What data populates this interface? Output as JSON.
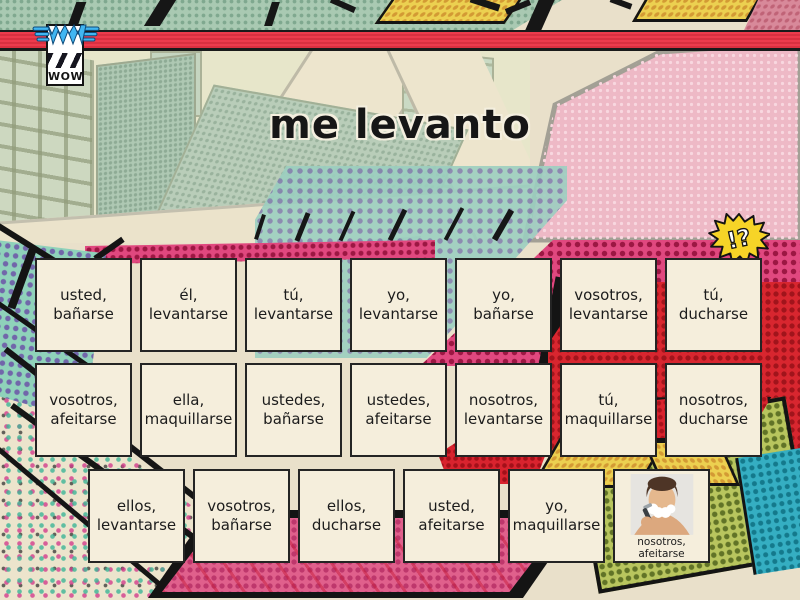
{
  "logo": {
    "text": "WOW"
  },
  "title": "me levanto",
  "burst": {
    "text": "!?"
  },
  "board": {
    "rows": [
      {
        "tiles": [
          {
            "label": "usted,\nbañarse"
          },
          {
            "label": "él,\nlevantarse"
          },
          {
            "label": "tú,\nlevantarse"
          },
          {
            "label": "yo,\nlevantarse"
          },
          {
            "label": "yo,\nbañarse"
          },
          {
            "label": "vosotros,\nlevantarse"
          },
          {
            "label": "tú,\nducharse"
          }
        ]
      },
      {
        "tiles": [
          {
            "label": "vosotros,\nafeitarse"
          },
          {
            "label": "ella,\nmaquillarse"
          },
          {
            "label": "ustedes,\nbañarse"
          },
          {
            "label": "ustedes,\nafeitarse"
          },
          {
            "label": "nosotros,\nlevantarse"
          },
          {
            "label": "tú,\nmaquillarse"
          },
          {
            "label": "nosotros,\nducharse"
          }
        ]
      },
      {
        "tiles": [
          {
            "label": "ellos,\nlevantarse"
          },
          {
            "label": "vosotros,\nbañarse"
          },
          {
            "label": "ellos,\nducharse"
          },
          {
            "label": "usted,\nafeitarse"
          },
          {
            "label": "yo,\nmaquillarse"
          },
          {
            "label": "nosotros,\nafeitarse",
            "image": "man-shaving-photo"
          }
        ]
      }
    ]
  },
  "palette": {
    "background_cream": "#e9e0ca",
    "banner_red": "#ed3b4c",
    "tile_bg": "#f5eedc",
    "tile_border": "#242424",
    "magenta_halftone": "#e0487f",
    "pink_panel": "#eeb9c6",
    "burst_yellow": "#f6d427",
    "logo_blue": "#41b6f2"
  }
}
